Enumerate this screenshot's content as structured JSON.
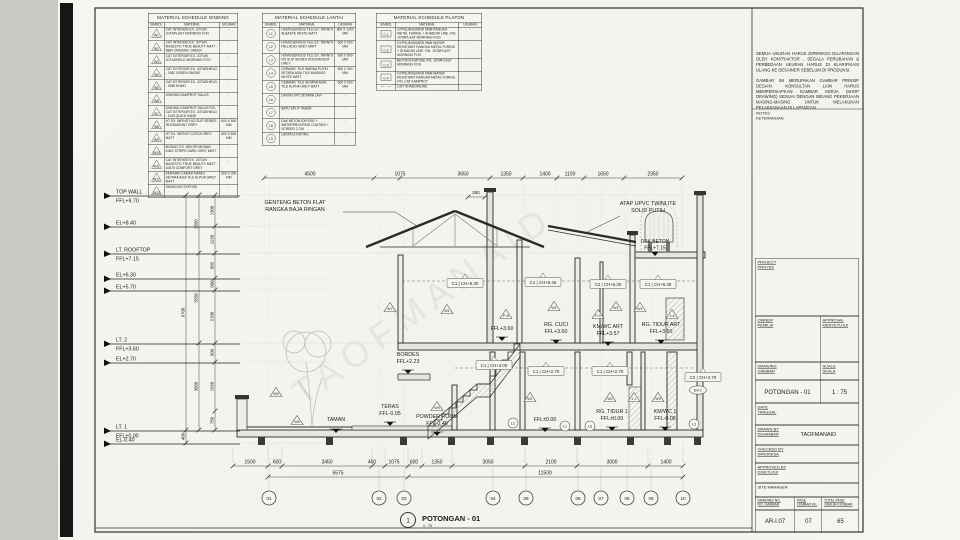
{
  "schedules": {
    "dinding": {
      "title": "MATERIAL SCHEDULE DINDING",
      "headers": [
        "SIMBOL",
        "MATERIAL",
        "UKURAN"
      ],
      "rows": [
        {
          "symbol": "W1",
          "material": "CAT INTERIOR EX. JOTUN JOTAPLAST MORNING FOG",
          "ukuran": "-"
        },
        {
          "symbol": "W2",
          "material": "CAT INTERIOR EX. JOTUN MAJESTIC TRUE BEAUTY MATT - 8884 ORGANIC GREEN",
          "ukuran": "-"
        },
        {
          "symbol": "W3",
          "material": "CAT EXTERIOR EX. JOTUN JOTASHIELD MORNING FOG",
          "ukuran": "-"
        },
        {
          "symbol": "W4",
          "material": "CAT EXTERIOR EX. JOTASHIELD - 7682 GREEN SMOKE",
          "ukuran": "-"
        },
        {
          "symbol": "W5",
          "material": "CAT EXTERIOR EX. JOTASHIELD - 7658 KHAKI",
          "ukuran": "-"
        },
        {
          "symbol": "W6",
          "material": "DINDING KAMPROT HALUS",
          "ukuran": "-"
        },
        {
          "symbol": "W7",
          "material": "DINDING KAMPROT HALUS FIN. CAT EXTERIOR EX. JOTASHIELD - 1105 QUICK SAND",
          "ukuran": "-"
        },
        {
          "symbol": "W8",
          "material": "HT EX. INFINITI NO SLIP SERIES ROCKMOUNT GREY",
          "ukuran": "600 X 600 MM"
        },
        {
          "symbol": "W9",
          "material": "HT EX. INFINITI COSTA GREY MATT",
          "ukuran": "600 X 600 MM"
        },
        {
          "symbol": "W10",
          "material": "MOSAIC EX. DEKOR MOSAIC KING STRIPE DARK GREY MATT",
          "ukuran": "-"
        },
        {
          "symbol": "W11",
          "material": "CAT INTERIOR EX. JOTUN MAJESTIC TRUE BEAUTY MATT - 10678 COMFORT GREY",
          "ukuran": "-"
        },
        {
          "symbol": "W12",
          "material": "KERAMIK KAMAR MANDI SETARA ASIA TILE ALPHA GREY MATT",
          "ukuran": "600 X 300 MM"
        },
        {
          "symbol": "W13",
          "material": "SKIMCOAT EXPOSE",
          "ukuran": "-"
        }
      ]
    },
    "lantai": {
      "title": "MATERIAL SCHEDULE LANTAI",
      "headers": [
        "SIMBOL",
        "MATERIAL",
        "UKURAN"
      ],
      "rows": [
        {
          "symbol": "L1",
          "material": "HOMOGENOUS TILE EX. INFINITI ALBASTE WHITE MATT",
          "ukuran": "800 X 1200 MM"
        },
        {
          "symbol": "L2",
          "material": "HOMOGENOUS TILE EX. INFINITI PALLADIO GREY MATT",
          "ukuran": "600 X 600 MM"
        },
        {
          "symbol": "L3",
          "material": "HOMOGENOUS TILE EX. INFINITI NO SLIP SERIES ROCKMOUNT GREY",
          "ukuran": "600 X 600 MM"
        },
        {
          "symbol": "L4",
          "material": "CERAMIC TILE WARNA PUTIH SETARA ASIA TILE MURANO WHITE MATT",
          "ukuran": "600 X 300 MM"
        },
        {
          "symbol": "L5",
          "material": "CERAMIC TILE SETARA ASIA TILE ALPHA GREY MATT",
          "ukuran": "600 X 600 MM"
        },
        {
          "symbol": "L6",
          "material": "LANTAI SPC SETARA LAVI",
          "ukuran": "-"
        },
        {
          "symbol": "L7",
          "material": "BATU SPLIT TABUR",
          "ukuran": "-"
        },
        {
          "symbol": "L8",
          "material": "DAK BETON EXPOSE + WATERPROOFING COATING + SCREED 2 CM",
          "ukuran": "-"
        },
        {
          "symbol": "L9",
          "material": "LANTAI EXISTING",
          "ukuran": "-"
        }
      ]
    },
    "plafon": {
      "title": "MATERIAL SCHEDULE PLAFON",
      "headers": [
        "SIMBOL",
        "MATERIAL",
        "UKURAN"
      ],
      "rows": [
        {
          "symbol": "C-1",
          "material": "GYPSUM BOARD 9MM RANGKA METAL FURING + SHADOW LINE, FIN. JOTAPLAST MORNING FOG",
          "ukuran": "-"
        },
        {
          "symbol": "C-2",
          "material": "GYPSUM BOARD 9MM WATER RESISTANT RANGKA METAL FURING + SHADOW LINE, FIN. JOTAPLAST MORNING FOG",
          "ukuran": "-"
        },
        {
          "symbol": "C-3",
          "material": "BETON EKSPOSE FIN. JOTAPLAST MORNING FOG",
          "ukuran": "-"
        },
        {
          "symbol": "C-4",
          "material": "GYPSUM BOARD 9MM WATER RESISTANT RANGKA METAL FURING FIN. CAT KAMPROT",
          "ukuran": "-"
        },
        {
          "symbol": "— · —",
          "material": "LIST SHADOWLINE",
          "ukuran": "-"
        }
      ]
    }
  },
  "notes": {
    "paragraphs": [
      "SEMUA UKURAN HARUS DIPERIKSA DILAPANGAN OLEH KONTRAKTOR , SEGALA PERUBAHAN & PERBEDAAN UKURAN HARUS DI KLARIFIKASI ULANG KE DESAINER SEBELUM DI PRODUKSI.",
      "GAMBAR INI MERUPAKAN GAMBAR PRINSIP DESAIN. KONSULTAN LAIN HARUS MEMPERSIAPKAN GAMBAR KERJA (SHOP DRAWING) SESUAI DENGAN BIDANG PEKERJAAN MASING-MASING UNTUK MELAKUKAN PELAKSANAAN DI LAPANGAN."
    ],
    "label_en": "NOTES",
    "label_id": "KETERANGAN"
  },
  "titleblock": {
    "project": {
      "en": "PROJECT",
      "id": "PROYEK"
    },
    "owner": {
      "en": "OWNER",
      "id": "PEMILIK"
    },
    "approval": {
      "en": "APPROVAL",
      "id": "MENYETUJUI"
    },
    "drawing": {
      "en": "DRAWING",
      "id": "GAMBAR",
      "value": "POTONGAN - 01"
    },
    "scale": {
      "en": "SCALE",
      "id": "SKALA",
      "value": "1 : 75"
    },
    "date": {
      "en": "DATE",
      "id": "TANGGAL"
    },
    "drawn_by": {
      "en": "DRAWN BY",
      "id": "DIGAMBAR",
      "value": "TAOFMANAID"
    },
    "checked_by": {
      "en": "CHECKED BY",
      "id": "DIPERIKSA"
    },
    "approved_by": {
      "en": "APPROVED BY",
      "id": "DISETUJUI"
    },
    "site_manager": "SITE MANAGER",
    "drawing_no": {
      "en": "DRAWING NO.",
      "id": "NO. GAMBAR",
      "value": "AR-I.07"
    },
    "page": {
      "en": "PAGE",
      "id": "LEMBAR KE-",
      "value": "07"
    },
    "total_page": {
      "en": "TOTAL PAGE",
      "id": "JUMLAH LEMBAR",
      "value": "65"
    }
  },
  "drawing": {
    "title": {
      "number": "1",
      "name": "POTONGAN - 01",
      "scale": "1 : 75"
    },
    "watermark": "TAOFMANAID",
    "annotations": {
      "roof_left": [
        "GENTENG BETON FLAT",
        "RANGKA BAJA RINGAN"
      ],
      "roof_right": [
        "ATAP UPVC TWINLITE",
        "SOLID PUTIH"
      ],
      "dak": [
        "DAK BETON",
        "FFL+7.15"
      ]
    },
    "levels": [
      {
        "name": "TOP WALL",
        "value": "FFL+9.70"
      },
      {
        "name": "",
        "value": "EL+8.40"
      },
      {
        "name": "LT. ROOFTOP",
        "value": "FFL+7.15"
      },
      {
        "name": "",
        "value": "EL+6.30"
      },
      {
        "name": "",
        "value": "EL+5.70"
      },
      {
        "name": "LT. 2",
        "value": "FFL+3.60"
      },
      {
        "name": "",
        "value": "EL+2.70"
      },
      {
        "name": "LT. 1",
        "value": "FFL±0.00"
      },
      {
        "name": "",
        "value": "EL-0.40"
      }
    ],
    "rooms": [
      {
        "name": "BORDES",
        "ffl": "FFL+2.23"
      },
      {
        "name": "",
        "ffl": "FFL+3.60"
      },
      {
        "name": "RG. CUCI",
        "ffl": "FFL+3.60"
      },
      {
        "name": "KM/WC ART",
        "ffl": "FFL+3.57"
      },
      {
        "name": "RG. TIDUR ART",
        "ffl": "FFL+3.60"
      },
      {
        "name": "TAMAN",
        "ffl": ""
      },
      {
        "name": "TERAS",
        "ffl": "FFL-0.05"
      },
      {
        "name": "POWDER ROOM",
        "ffl": "FFL-0.40"
      },
      {
        "name": "",
        "ffl": "FFL±0.00"
      },
      {
        "name": "RG. TIDUR 1",
        "ffl": "FFL±0.00"
      },
      {
        "name": "KM/WC 1",
        "ffl": "FFL-0.05"
      }
    ],
    "ceiling_tags": [
      "C1 | CH+6.30",
      "C1 | CH+6.45",
      "C2 | CH+6.30",
      "C1 | CH+6.30",
      "C1 | CH+3.00",
      "C1 | CH+2.70",
      "C1 | CH+2.70",
      "C2 | CH+2.70"
    ],
    "material_tags": [
      "W7",
      "W1",
      "W1",
      "P-8",
      "W1",
      "P-9",
      "W1",
      "J-4",
      "W6",
      "W6",
      "W9",
      "W1",
      "W2",
      "J-1",
      "W9",
      "L1",
      "L1",
      "L6",
      "L3",
      "BV-1"
    ],
    "dims": {
      "top": [
        "4500",
        "1075",
        "3650",
        "1350",
        "1400",
        "1100",
        "1650",
        "2350"
      ],
      "top_sub": "350",
      "bottom": [
        "1500",
        "600",
        "3450",
        "450",
        "1075",
        "600",
        "1350",
        "3050",
        "2100",
        "3000",
        "1400"
      ],
      "bottom2": [
        "5575",
        "11500"
      ],
      "left_inner": [
        "1300",
        "1250",
        "850",
        "600",
        "2100",
        "900",
        "1950",
        "750"
      ],
      "left_mid": [
        "2550",
        "3550",
        "3600"
      ],
      "left_outer": [
        "9700",
        "400"
      ]
    },
    "grid_bubbles": [
      "01",
      "02",
      "03",
      "04",
      "05",
      "06",
      "07",
      "08",
      "09",
      "10"
    ]
  }
}
